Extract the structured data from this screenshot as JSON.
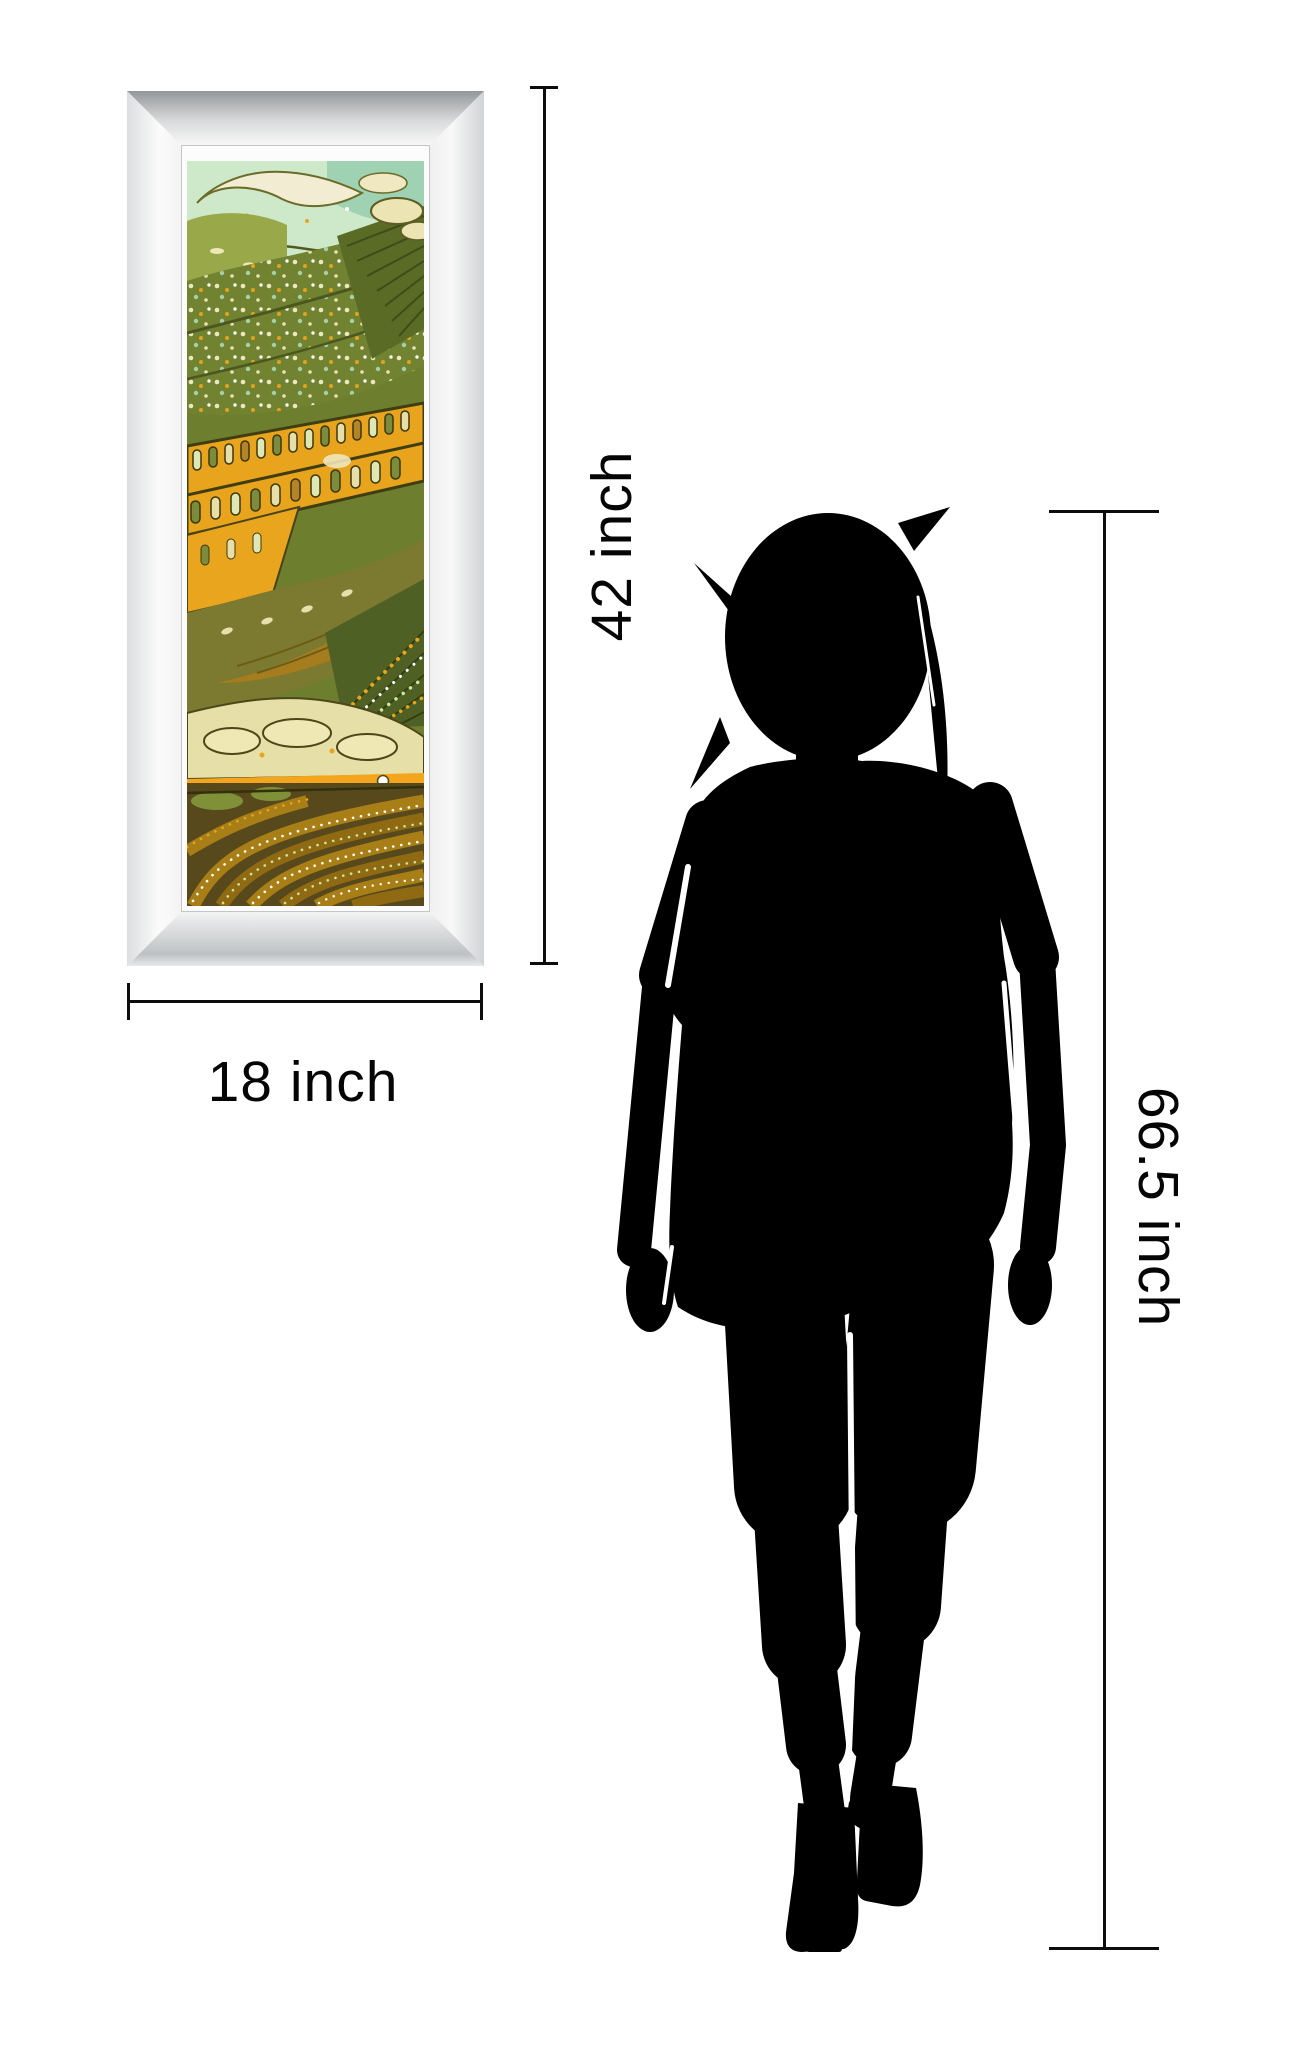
{
  "scene": {
    "background": "#ffffff",
    "annotation_color": "#0c0c0c",
    "description": "wall art size comparison diagram"
  },
  "framed_art": {
    "name": "mirror framed batik landscape print",
    "frame_colors": {
      "band_top": "#94979a",
      "band_left": "#dcdedf",
      "band_right": "#d0d3d5",
      "band_bottom": "#bec1c3",
      "inner_lip": "#fcfcfc"
    },
    "art_palette": [
      "#cde9c9",
      "#9fd2b2",
      "#6d7e2e",
      "#99a94a",
      "#e9a41e",
      "#7b7a30",
      "#e7dfa8",
      "#a87e17",
      "#57491b",
      "#f2ecd2",
      "#4f6024",
      "#3f3d12"
    ]
  },
  "annotations": {
    "frame_height": {
      "label": "42 inch"
    },
    "frame_width": {
      "label": "18 inch"
    },
    "person_height": {
      "label": "66.5 inch"
    }
  },
  "figure": {
    "name": "woman silhouette",
    "color": "#000000"
  }
}
